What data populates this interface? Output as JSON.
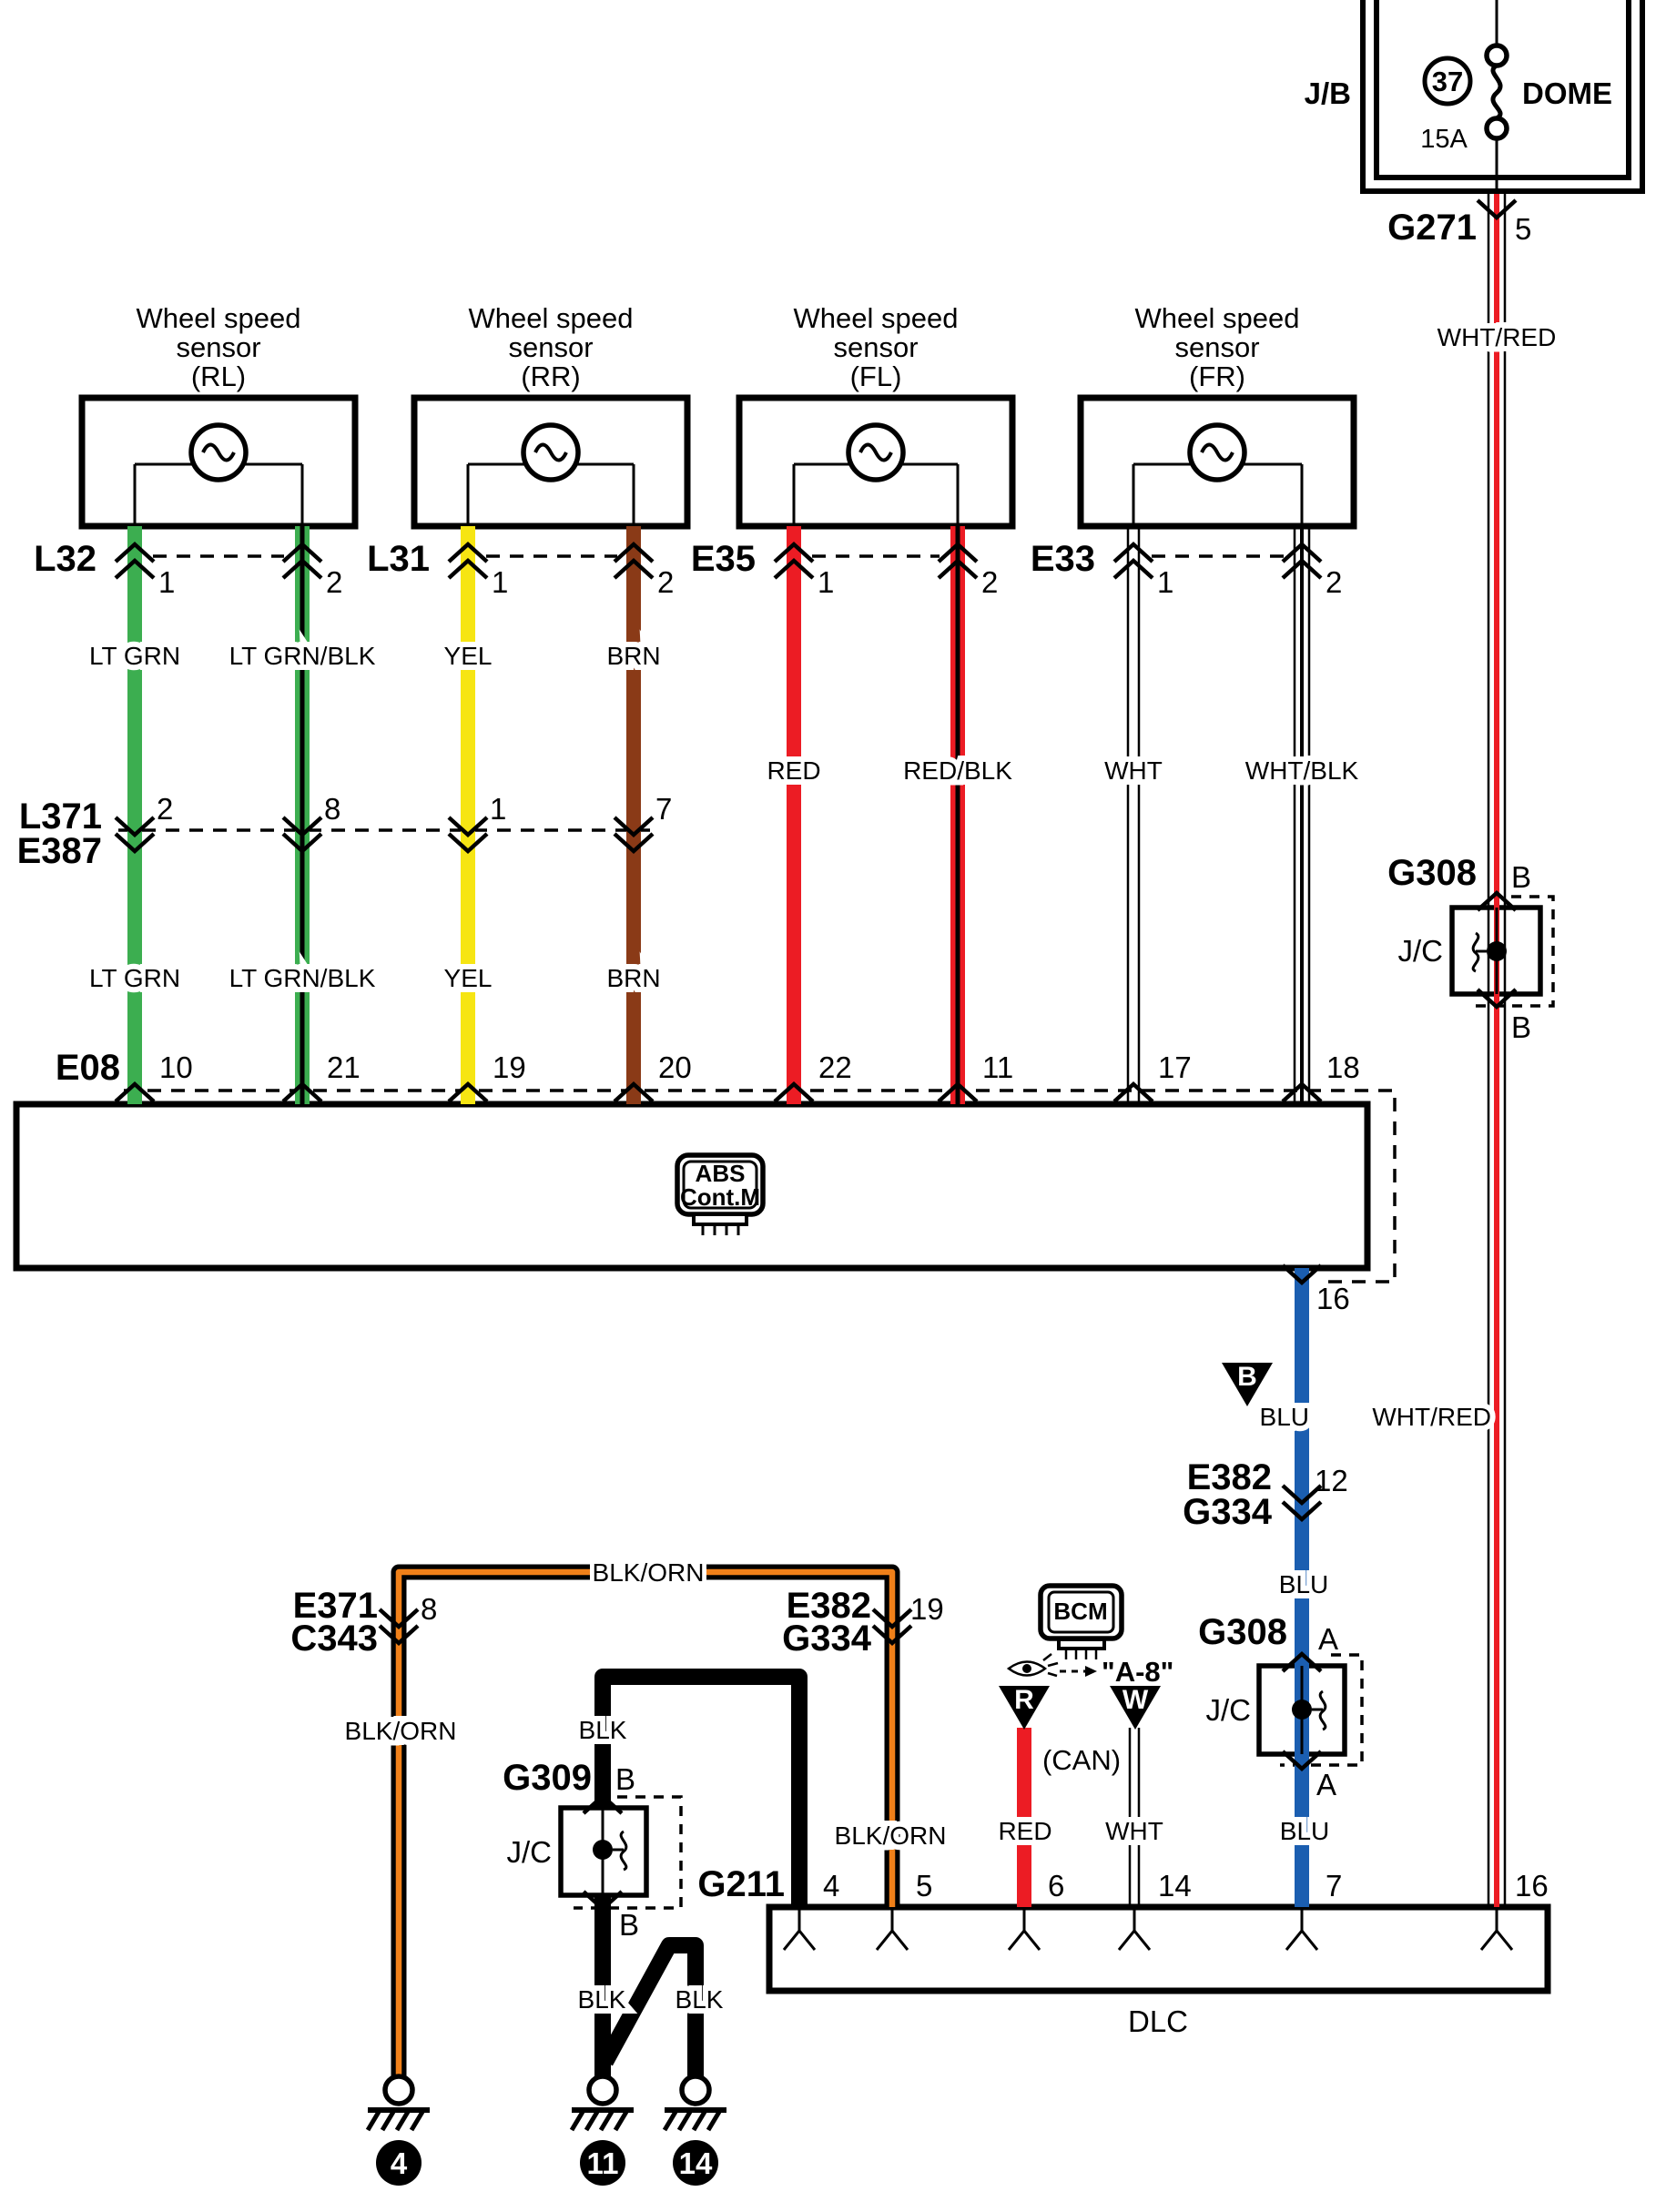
{
  "colors": {
    "green": "#3cae50",
    "yellow": "#f6e513",
    "brown": "#8a3a17",
    "red": "#ec1c24",
    "blue": "#1b5eb0",
    "orange": "#f08019",
    "black": "#000000"
  },
  "sensors": [
    {
      "title1": "Wheel speed",
      "title2": "sensor",
      "title3": "(RL)",
      "conn": "L32",
      "pin1": "1",
      "pin2": "2"
    },
    {
      "title1": "Wheel speed",
      "title2": "sensor",
      "title3": "(RR)",
      "conn": "L31",
      "pin1": "1",
      "pin2": "2"
    },
    {
      "title1": "Wheel speed",
      "title2": "sensor",
      "title3": "(FL)",
      "conn": "E35",
      "pin1": "1",
      "pin2": "2"
    },
    {
      "title1": "Wheel speed",
      "title2": "sensor",
      "title3": "(FR)",
      "conn": "E33",
      "pin1": "1",
      "pin2": "2"
    }
  ],
  "wire_labels": {
    "row1": [
      "LT GRN",
      "LT GRN/BLK",
      "YEL",
      "BRN"
    ],
    "row2": [
      "RED",
      "RED/BLK",
      "WHT",
      "WHT/BLK"
    ],
    "row3": [
      "LT GRN",
      "LT GRN/BLK",
      "YEL",
      "BRN"
    ]
  },
  "connectors": {
    "mid": {
      "name1": "L371",
      "name2": "E387",
      "pins": [
        "2",
        "8",
        "1",
        "7"
      ]
    },
    "e08": {
      "name": "E08",
      "pins": [
        "10",
        "21",
        "19",
        "20",
        "22",
        "11",
        "17",
        "18"
      ],
      "pin16": "16"
    },
    "g271": {
      "name": "G271",
      "pin": "5"
    },
    "e382_g334_blu": {
      "name1": "E382",
      "name2": "G334",
      "pin": "12"
    },
    "e382_g334_blkorn": {
      "name1": "E382",
      "name2": "G334",
      "pin": "19"
    },
    "e371_c343": {
      "name1": "E371",
      "name2": "C343",
      "pin": "8"
    },
    "g211": {
      "name": "G211",
      "pins": [
        "4",
        "5",
        "6",
        "14",
        "7",
        "16"
      ]
    }
  },
  "jb": {
    "name": "J/B",
    "fuse_no": "37",
    "fuse_amps": "15A",
    "fuse_name": "DOME"
  },
  "abs": {
    "line1": "ABS",
    "line2": "Cont.M"
  },
  "bcm": {
    "name": "BCM",
    "ref": "\"A-8\"",
    "can": "(CAN)"
  },
  "jc": {
    "g308": "G308",
    "g309": "G309",
    "label": "J/C",
    "pin_a": "A",
    "pin_b": "B"
  },
  "triangles": {
    "b": "B",
    "r": "R",
    "w": "W"
  },
  "labels": {
    "wht_red": "WHT/RED",
    "blu": "BLU",
    "blk": "BLK",
    "blk_orn": "BLK/ORN",
    "red": "RED",
    "wht": "WHT",
    "dlc": "DLC"
  },
  "grounds": [
    "4",
    "11",
    "14"
  ]
}
